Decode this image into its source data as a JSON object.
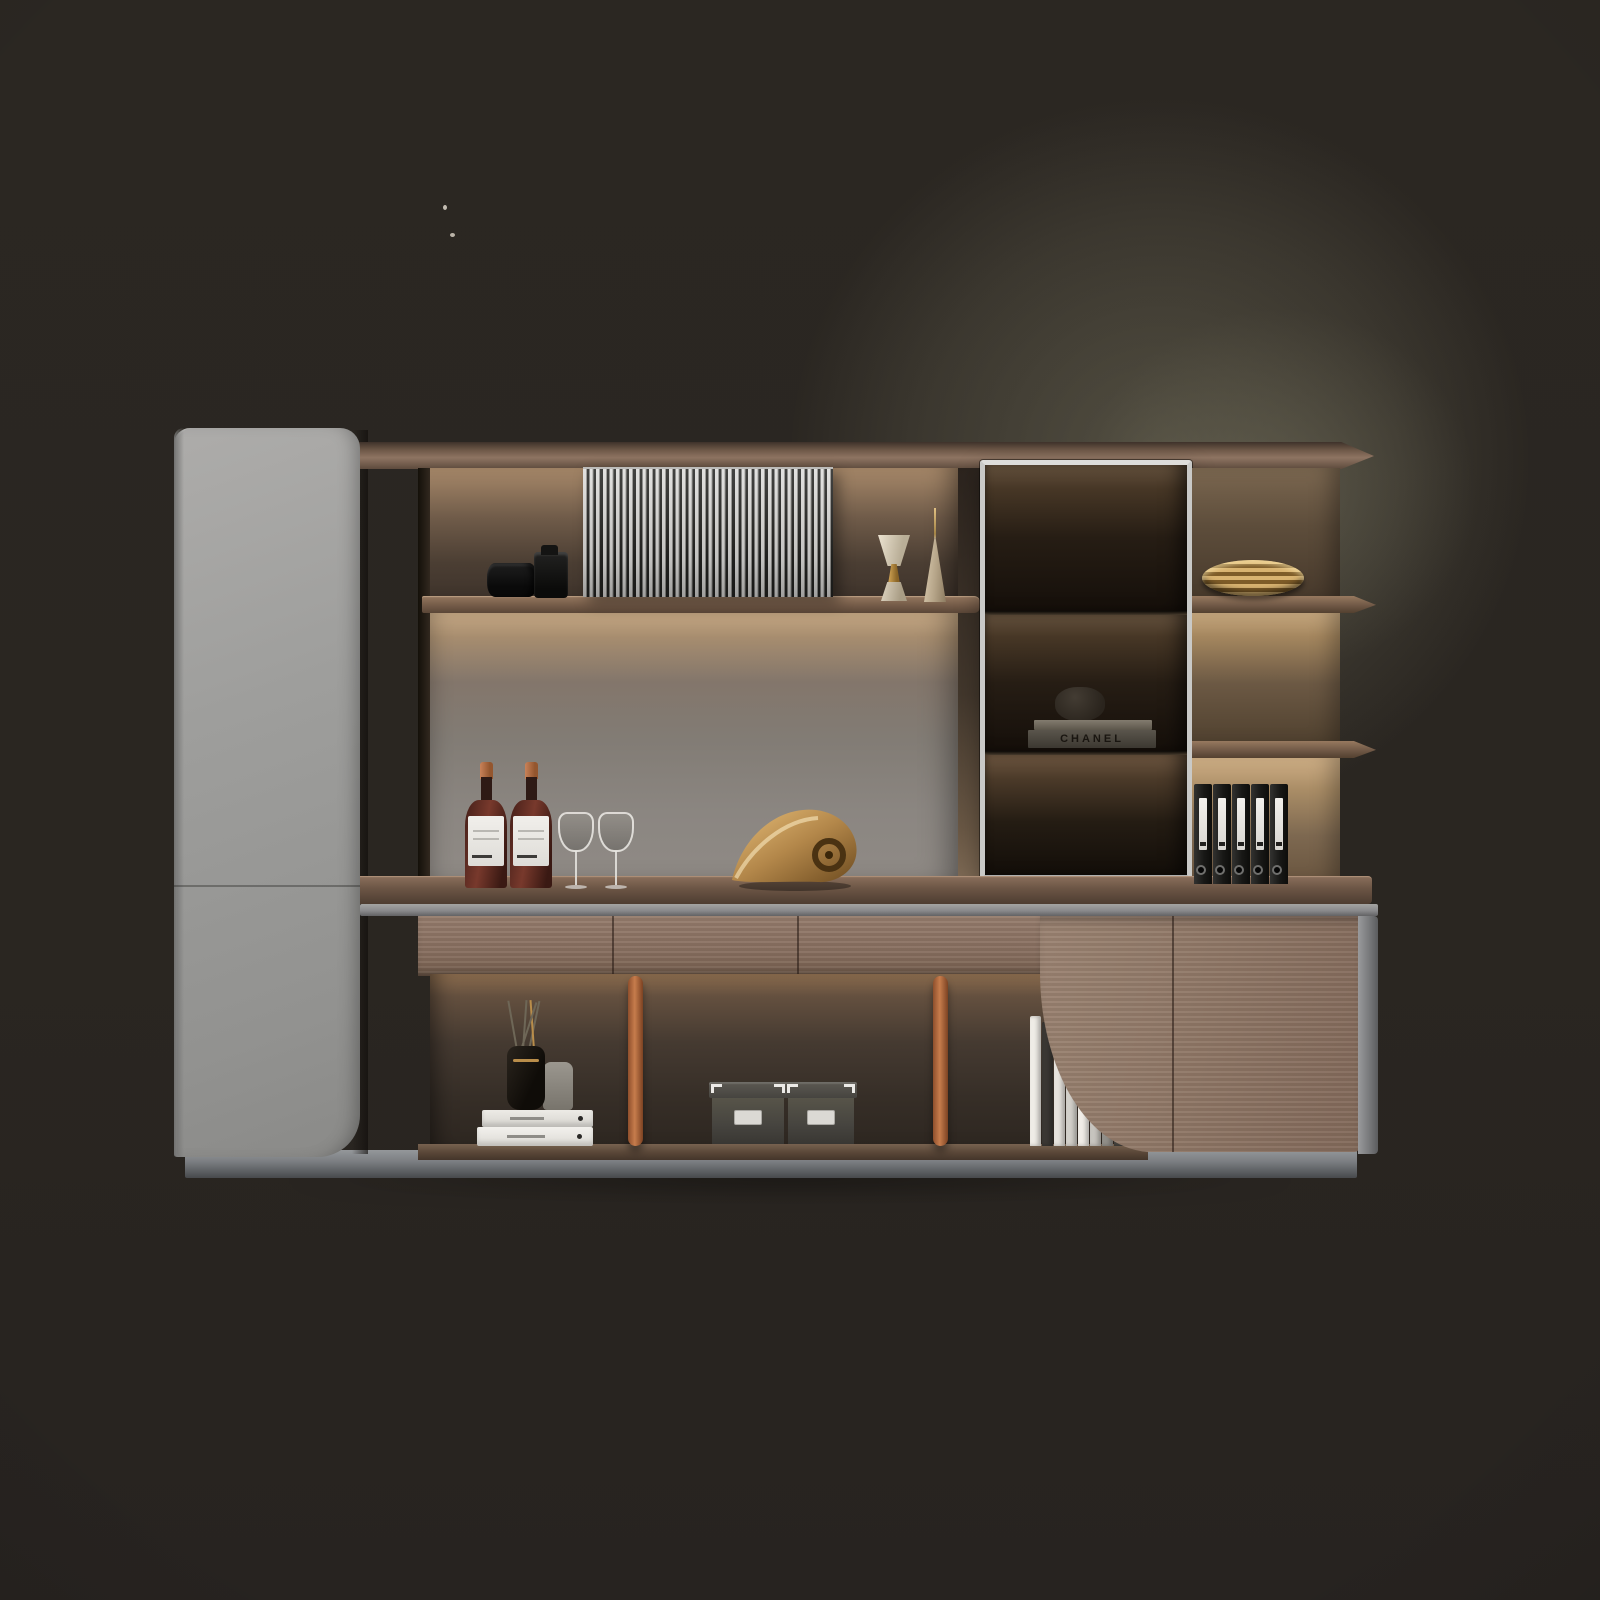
{
  "image": {
    "kind": "3d product render photo",
    "subject": "modern wall-mounted office bookcase and display cabinet combination with LED shelf lighting",
    "background": "dark studio wall with soft olive glow in upper right"
  },
  "palette": {
    "background": "#2a2621",
    "glow": "#7e7a64",
    "gray_cabinet": "#9e9e9c",
    "wood_dark": "#6b5545",
    "wood_light": "#8e7665",
    "aluminum_trim": "#8a8a8c",
    "glass_frame": "#c9c9c7",
    "smoked_glass": "#16120d",
    "copper_pole": "#c67c4c",
    "brass_gold": "#d9b370",
    "plinth": "#7c7f83"
  },
  "glass_cabinet": {
    "rows": 3,
    "brand_text_on_book": "CHANEL"
  },
  "counts": {
    "slats_on_sliding_door": 38,
    "black_binders": 5,
    "wine_bottles": 2,
    "wine_glasses": 2,
    "storage_boxes": 2,
    "copper_support_poles": 2,
    "leaning_books": 9,
    "stacked_white_books": 2,
    "gold_plates_stack": 1
  },
  "decor_items": [
    {
      "name": "dslr-camera"
    },
    {
      "name": "slatted-sliding-panel"
    },
    {
      "name": "gold-jigger-ornament"
    },
    {
      "name": "gold-cone-spire"
    },
    {
      "name": "smoked-glass-display-cabinet"
    },
    {
      "name": "chanel-book-stack"
    },
    {
      "name": "gold-plate-stack"
    },
    {
      "name": "black-lever-arch-binders"
    },
    {
      "name": "wine-bottles"
    },
    {
      "name": "wine-glasses"
    },
    {
      "name": "golden-conch-sculpture"
    },
    {
      "name": "white-book-stack-with-diffuser"
    },
    {
      "name": "grey-storage-boxes"
    },
    {
      "name": "leaning-white-books"
    },
    {
      "name": "copper-poles"
    }
  ],
  "leaning_books": {
    "heights": [
      130,
      124,
      114,
      102,
      90,
      76,
      62,
      48,
      36
    ],
    "colors": [
      "#efece6",
      "#3a3733",
      "#e6e3dd",
      "#d3d0ca",
      "#f0ede7",
      "#c7c4be",
      "#918e88",
      "#45423d",
      "#cbc8c2"
    ]
  },
  "bottle_offsets": [
    0,
    45
  ],
  "glass_offsets": [
    0,
    40
  ],
  "pole_lefts": [
    628,
    933
  ],
  "drawer_seams": [
    194,
    379
  ]
}
